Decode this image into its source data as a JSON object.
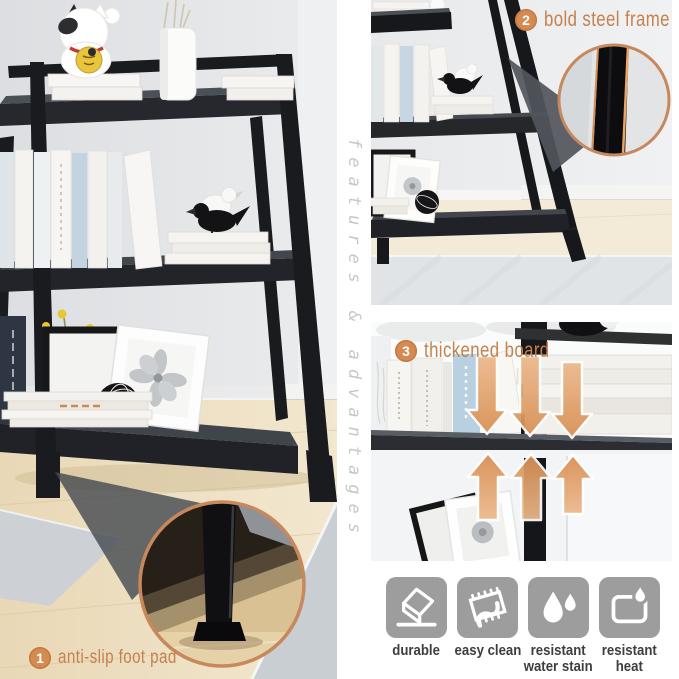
{
  "canvas": {
    "width": 679,
    "height": 679,
    "background": "#ffffff"
  },
  "colors": {
    "accent_orange": "#c5814e",
    "badge_orange": "#d58a52",
    "copper_ring": "#c6885c",
    "arrow_orange": "#dd9664",
    "icon_gray": "#9d9d9d",
    "icon_label_text": "#3e3e3e",
    "caption_gray": "#c6c7c9"
  },
  "side_caption": {
    "text": "features & advantages"
  },
  "callouts": {
    "foot_pad": {
      "number": "1",
      "label": "anti-slip foot pad"
    },
    "steel_frame": {
      "number": "2",
      "label": "bold steel frame"
    },
    "board": {
      "number": "3",
      "label": "thickened board"
    }
  },
  "features": {
    "items": [
      {
        "icon": "eraser-icon",
        "line1": "durable",
        "line2": ""
      },
      {
        "icon": "wipe-clean-icon",
        "line1": "easy clean",
        "line2": ""
      },
      {
        "icon": "water-drops-icon",
        "line1": "resistant",
        "line2": "water stain"
      },
      {
        "icon": "heat-flame-icon",
        "line1": "resistant",
        "line2": "heat"
      }
    ]
  },
  "panels": {
    "left": {
      "alt": "black ladder bookshelf styled with books, lucky cat figurine, vase, bird figurines and framed flower print; zoom circle on anti-slip foot pad"
    },
    "top_right": {
      "alt": "bookshelf corner view with zoom circle on bold steel frame post"
    },
    "bottom_right": {
      "alt": "close-up of thick shelf board holding books and a bird figurine, arrows pressing on the board"
    }
  }
}
